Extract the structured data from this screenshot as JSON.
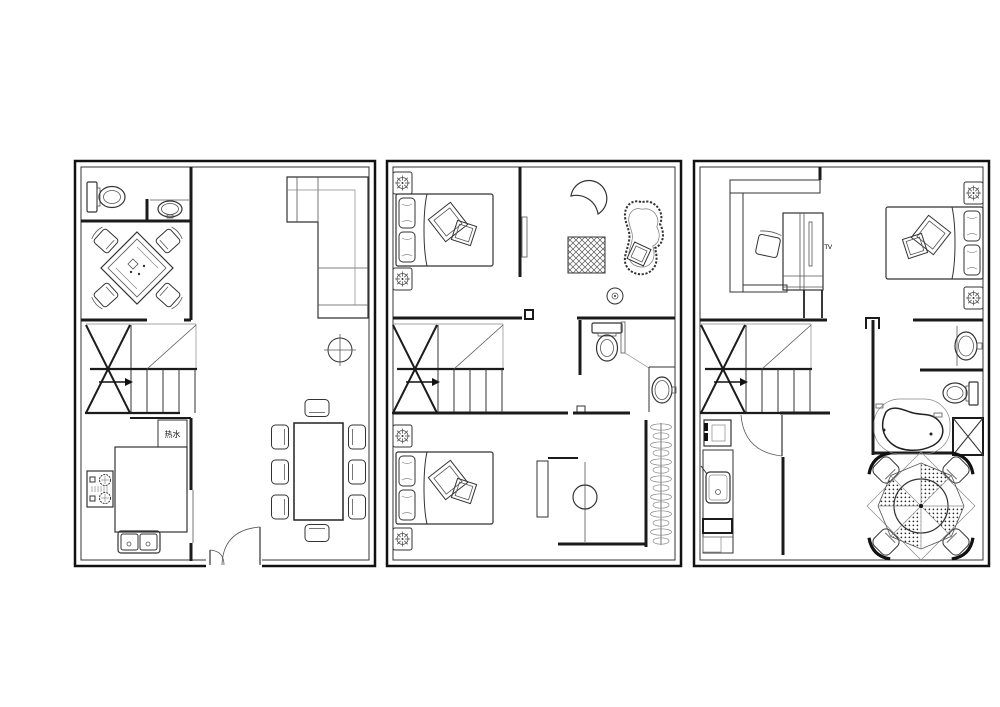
{
  "meta": {
    "type": "architectural-floor-plan",
    "sheets": 3,
    "background": "#ffffff"
  },
  "colors": {
    "wall": "#1b1b1b",
    "border": "#111111",
    "furniture": "#333333",
    "light_line": "#888888",
    "hatch": "#555555",
    "dots": "#2b2b2b"
  },
  "labels": {
    "water_heater": "热水",
    "tv_cabinet": "TV"
  },
  "floors": [
    {
      "id": "floor-plan-level-1",
      "rooms": [
        "bathroom",
        "tea-room",
        "living-room",
        "staircase",
        "kitchen",
        "dining-area",
        "entry"
      ],
      "furniture": [
        "toilet",
        "wash-basin",
        "mahjong-table",
        "square-chairs-4",
        "l-shaped-sofa",
        "ceiling-light",
        "stair-direction-arrow",
        "water-heater-box",
        "kitchen-island",
        "gas-cooktop",
        "double-bowl-sink",
        "dining-table",
        "dining-chairs-8",
        "double-swing-entry-door"
      ]
    },
    {
      "id": "floor-plan-level-2",
      "rooms": [
        "bedroom-front",
        "lounge",
        "bathroom",
        "stair-hall",
        "bedroom-back",
        "dressing-area",
        "wardrobe"
      ],
      "furniture": [
        "double-bed-front",
        "double-bed-back",
        "nightstands-with-lamps-4",
        "crescent-pouf",
        "fluffy-chaise",
        "hatched-rug",
        "ceiling-light",
        "toilet",
        "wash-basin",
        "shower-screen",
        "dressing-desk",
        "stool",
        "hanging-clothes-rail"
      ]
    },
    {
      "id": "floor-plan-level-3",
      "rooms": [
        "study",
        "master-bedroom",
        "bathroom",
        "stair-hall",
        "kitchenette",
        "terrace"
      ],
      "furniture": [
        "l-shaped-desk",
        "desk-chair",
        "tv-wardrobe-cabinet",
        "double-bed",
        "nightstands-with-lamps-2",
        "wash-basin",
        "toilet",
        "spa-bathtub",
        "shower-platform",
        "swing-door",
        "side-cabinet",
        "kitchenette-counter-sink",
        "parasol-dining-table",
        "patio-chairs-4"
      ]
    }
  ]
}
